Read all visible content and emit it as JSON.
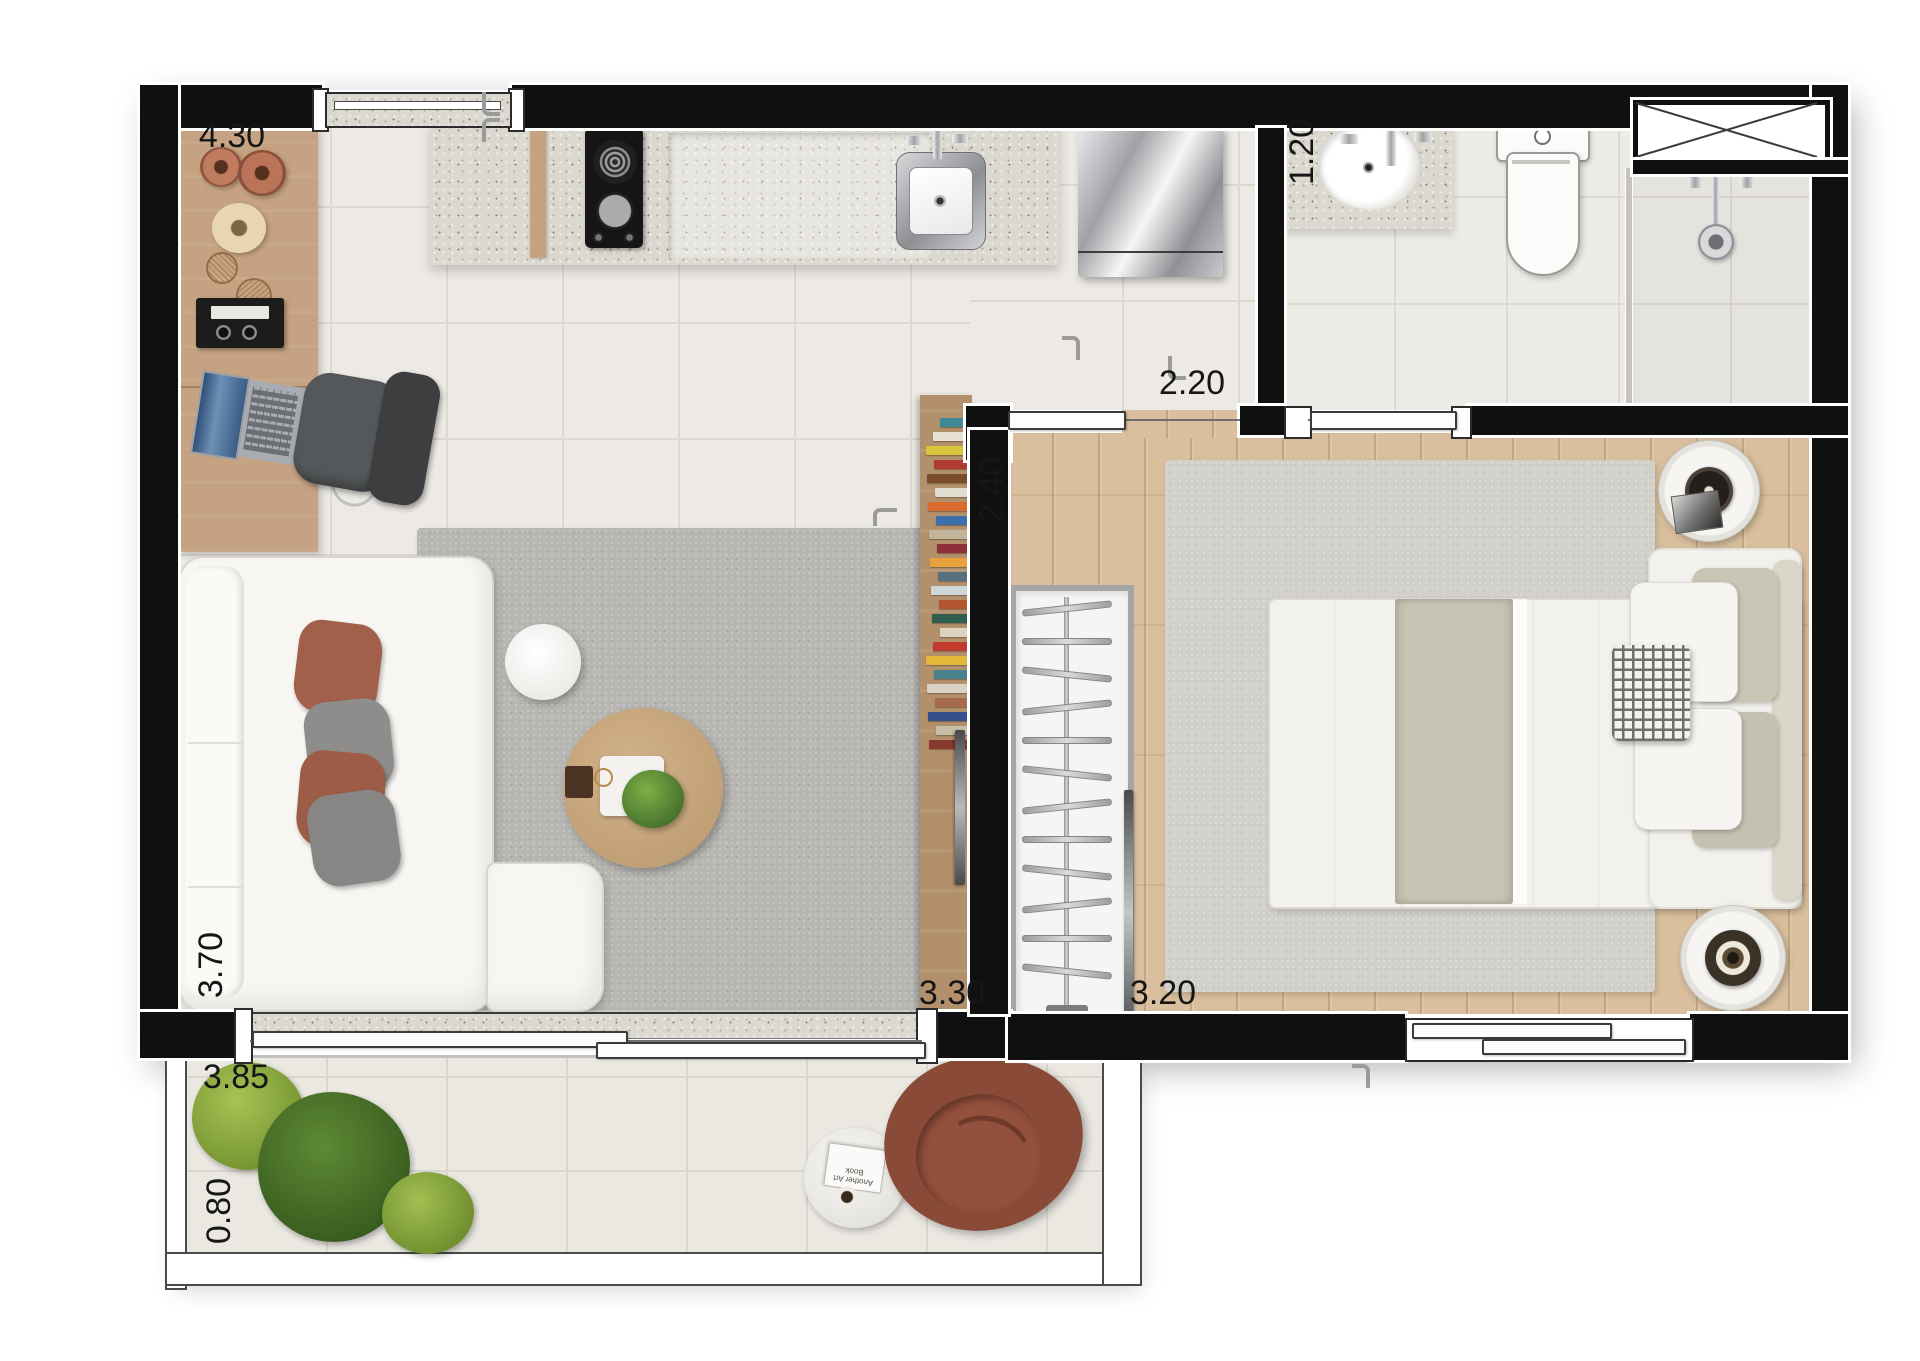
{
  "plan": {
    "kind": "residential studio apartment floor plan, rendered top view",
    "rooms": [
      "living-kitchen",
      "bathroom",
      "bedroom",
      "balcony"
    ]
  },
  "dimensions": {
    "kitchen_wall": {
      "value": "4.30",
      "orientation": "horizontal"
    },
    "bathroom_width": {
      "value": "1.20",
      "orientation": "vertical"
    },
    "bathroom_length": {
      "value": "2.20",
      "orientation": "horizontal"
    },
    "bedroom_depth": {
      "value": "2.40",
      "orientation": "vertical"
    },
    "living_depth": {
      "value": "3.70",
      "orientation": "vertical"
    },
    "living_length": {
      "value": "3.30",
      "orientation": "horizontal"
    },
    "bedroom_width": {
      "value": "3.20",
      "orientation": "horizontal"
    },
    "balcony_length": {
      "value": "3.85",
      "orientation": "horizontal"
    },
    "balcony_depth": {
      "value": "0.80",
      "orientation": "vertical"
    }
  },
  "balcony": {
    "side_table_book_text": "Another Art Book"
  },
  "closet": {
    "hanger_count": 12
  },
  "books": [
    "#3d8a96",
    "#e8e2d4",
    "#d9c53a",
    "#b03a30",
    "#7a4a2f",
    "#e0dcd0",
    "#d96b2f",
    "#3b6fae",
    "#c2b49a",
    "#8c2f3b",
    "#e8a13c",
    "#56707e",
    "#cfd6d8",
    "#b3552e",
    "#2e5e50",
    "#ddd3be",
    "#c23b2e",
    "#e3b83a",
    "#4a7f8c",
    "#d8d2c4",
    "#a66a52",
    "#35508c",
    "#c9bfa8",
    "#89382f"
  ],
  "colors": {
    "wall": "#101010",
    "floor_tile": "#edeae5",
    "wood_light": "#d9bf9d",
    "wood_desk": "#c5a281",
    "wood_panel": "#b3906c",
    "granite": "#dbd8d0",
    "rug_living": "#b9b7b3",
    "rug_bedroom": "#d2d0cb",
    "sofa": "#f7f6f3",
    "pillow_terracotta": "#a2604a",
    "pillow_gray": "#8e8d8b",
    "armchair": "#8a4a38",
    "plant_light": "#8fae3f",
    "plant_dark": "#4e7c2c",
    "bed_white": "#f3f1ec",
    "blanket": "#c8c4b3",
    "stainless": "#b9babc"
  }
}
